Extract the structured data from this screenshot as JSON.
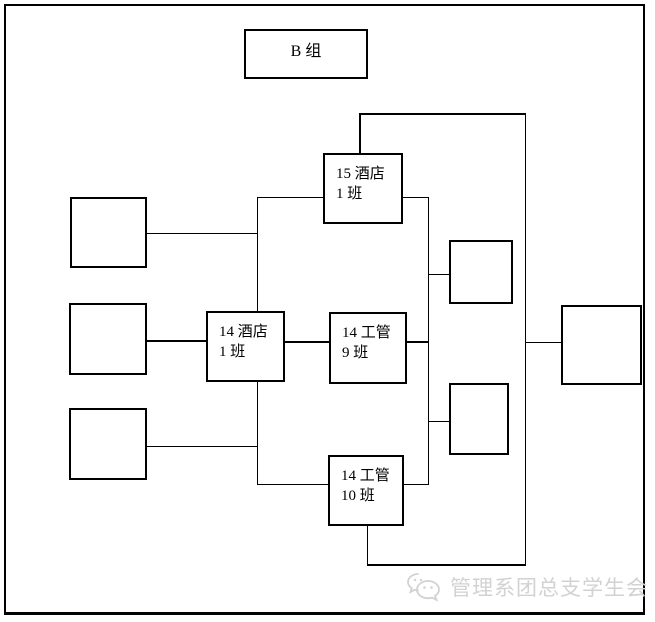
{
  "diagram": {
    "nodes": {
      "b_group": {
        "label": "B 组"
      },
      "hotel_15_1": {
        "line1": "15 酒店",
        "line2": "1 班"
      },
      "hotel_14_1": {
        "line1": "14 酒店",
        "line2": "1 班"
      },
      "gongguan_14_9": {
        "line1": "14 工管",
        "line2": "9 班"
      },
      "gongguan_14_10": {
        "line1": "14 工管",
        "line2": "10 班"
      },
      "left_top": {
        "label": ""
      },
      "left_middle": {
        "label": ""
      },
      "left_bottom": {
        "label": ""
      },
      "right_upper": {
        "label": ""
      },
      "right_lower": {
        "label": ""
      },
      "far_right": {
        "label": ""
      }
    },
    "connections": [
      "left_top - hotel_15_1 (via left vertical connector)",
      "left_middle - hotel_14_1",
      "left_bottom - gongguan_14_10 (via left vertical connector)",
      "hotel_14_1 - gongguan_14_9",
      "hotel_15_1 - right vertical connector",
      "gongguan_14_9 - right vertical connector",
      "right vertical connector - right_upper",
      "right vertical connector - right_lower",
      "right vertical connector - gongguan_14_10",
      "hotel_15_1 top bracket - far_right - gongguan_14_10 bottom bracket"
    ],
    "line_color": "#000000",
    "box_fill": "#ffffff"
  },
  "watermark": {
    "icon": "wechat-icon",
    "text": "管理系团总支学生会",
    "color": "#d2d2d2"
  }
}
